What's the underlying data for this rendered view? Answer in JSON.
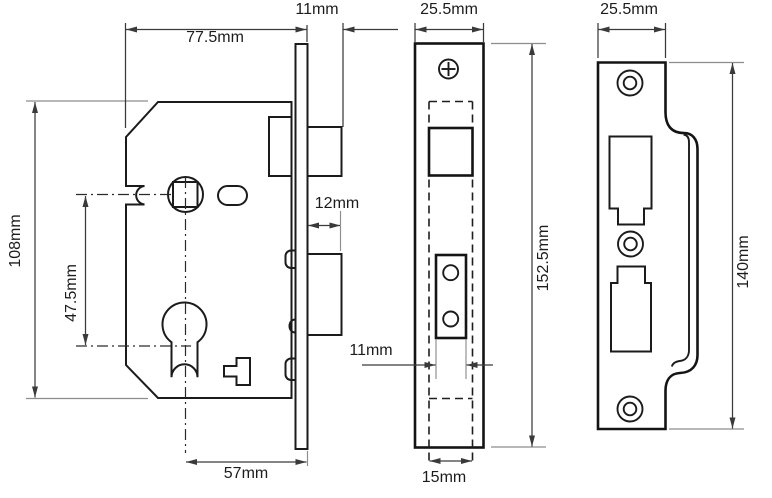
{
  "diagram": {
    "type": "technical-drawing",
    "subject": "mortice-sashlock-dimensions",
    "unit": "mm",
    "views": {
      "lock_body": {
        "name": "lock case side view",
        "dims": {
          "case_width": "77.5mm",
          "latch_projection": "11mm",
          "deadbolt_projection": "12mm",
          "case_height": "108mm",
          "centres": "47.5mm",
          "backset": "57mm"
        }
      },
      "faceplate": {
        "name": "faceplate front view",
        "dims": {
          "width": "25.5mm",
          "height": "152.5mm",
          "bolt_width": "11mm",
          "inner_width": "15mm"
        }
      },
      "strike_plate": {
        "name": "strike plate front view",
        "dims": {
          "width": "25.5mm",
          "height": "140mm"
        }
      }
    }
  }
}
